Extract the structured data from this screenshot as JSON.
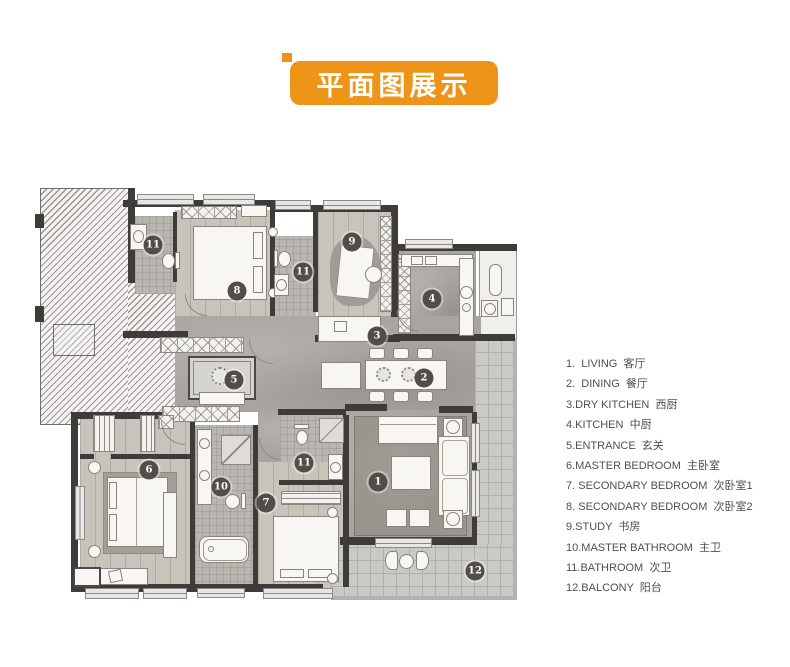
{
  "header": {
    "title": "平面图展示",
    "accent_color": "#ee9418"
  },
  "legend": {
    "items": [
      {
        "label": "1.  LIVING  客厅"
      },
      {
        "label": "2.  DINING  餐厅"
      },
      {
        "label": "3.DRY KITCHEN  西厨"
      },
      {
        "label": "4.KITCHEN  中厨"
      },
      {
        "label": "5.ENTRANCE  玄关"
      },
      {
        "label": "6.MASTER BEDROOM  主卧室"
      },
      {
        "label": "7. SECONDARY BEDROOM  次卧室1"
      },
      {
        "label": "8. SECONDARY BEDROOM  次卧室2"
      },
      {
        "label": "9.STUDY  书房"
      },
      {
        "label": "10.MASTER BATHROOM  主卫"
      },
      {
        "label": "11.BATHROOM  次卫"
      },
      {
        "label": "12.BALCONY  阳台"
      }
    ]
  },
  "plan": {
    "markers": [
      {
        "num": "11",
        "room": "bathroom",
        "x": 118,
        "y": 97
      },
      {
        "num": "8",
        "room": "secondary-bedroom-2",
        "x": 202,
        "y": 143
      },
      {
        "num": "11",
        "room": "bathroom",
        "x": 268,
        "y": 124
      },
      {
        "num": "9",
        "room": "study",
        "x": 317,
        "y": 94
      },
      {
        "num": "4",
        "room": "kitchen",
        "x": 397,
        "y": 151
      },
      {
        "num": "3",
        "room": "dry-kitchen",
        "x": 342,
        "y": 188
      },
      {
        "num": "2",
        "room": "dining",
        "x": 389,
        "y": 230
      },
      {
        "num": "5",
        "room": "entrance",
        "x": 199,
        "y": 232
      },
      {
        "num": "6",
        "room": "master-bedroom",
        "x": 114,
        "y": 322
      },
      {
        "num": "10",
        "room": "master-bathroom",
        "x": 186,
        "y": 339
      },
      {
        "num": "11",
        "room": "bathroom",
        "x": 269,
        "y": 315
      },
      {
        "num": "7",
        "room": "secondary-bedroom-1",
        "x": 231,
        "y": 355
      },
      {
        "num": "1",
        "room": "living",
        "x": 343,
        "y": 334
      },
      {
        "num": "12",
        "room": "balcony",
        "x": 440,
        "y": 423
      }
    ]
  },
  "colors": {
    "wall": "#3e3c39",
    "marker": "#534d49",
    "accent": "#ee9418"
  }
}
